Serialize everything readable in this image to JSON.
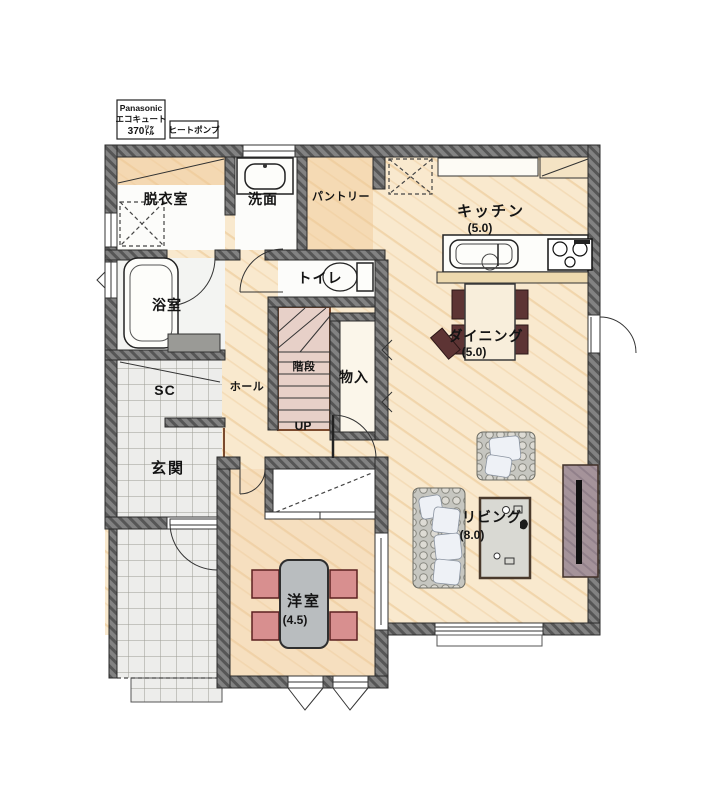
{
  "plan_title": "1F floor plan",
  "equipment": {
    "ecocute_line1": "Panasonic",
    "ecocute_line2": "エコキュート",
    "ecocute_line3": "370㍑",
    "heat_pump": "ヒートポンプ"
  },
  "rooms": {
    "datsui": {
      "label": "脱衣室"
    },
    "senmen": {
      "label": "洗面"
    },
    "pantry": {
      "label": "パントリー"
    },
    "kitchen": {
      "label": "キッチン",
      "size": "(5.0)"
    },
    "toilet": {
      "label": "トイレ"
    },
    "bathroom": {
      "label": "浴室"
    },
    "dining": {
      "label": "ダイニング",
      "size": "(5.0)"
    },
    "stairs": {
      "label": "階段",
      "direction": "UP"
    },
    "storage": {
      "label": "物入"
    },
    "hall": {
      "label": "ホール"
    },
    "shoe_closet": {
      "label": "SC"
    },
    "genkan": {
      "label": "玄関"
    },
    "living": {
      "label": "リビング",
      "size": "(8.0)"
    },
    "youshitsu": {
      "label": "洋室",
      "size": "(4.5)"
    }
  },
  "colors": {
    "wall": "#7d7d7d",
    "wood_floor": "#f9e9ce",
    "tile_floor": "#ededeb",
    "stairs": "#e7d0c8",
    "chair_pink": "#d88f8f",
    "chair_dark": "#5d3434",
    "rug_border": "#4a3a2c",
    "tv_board": "#a5939a"
  }
}
